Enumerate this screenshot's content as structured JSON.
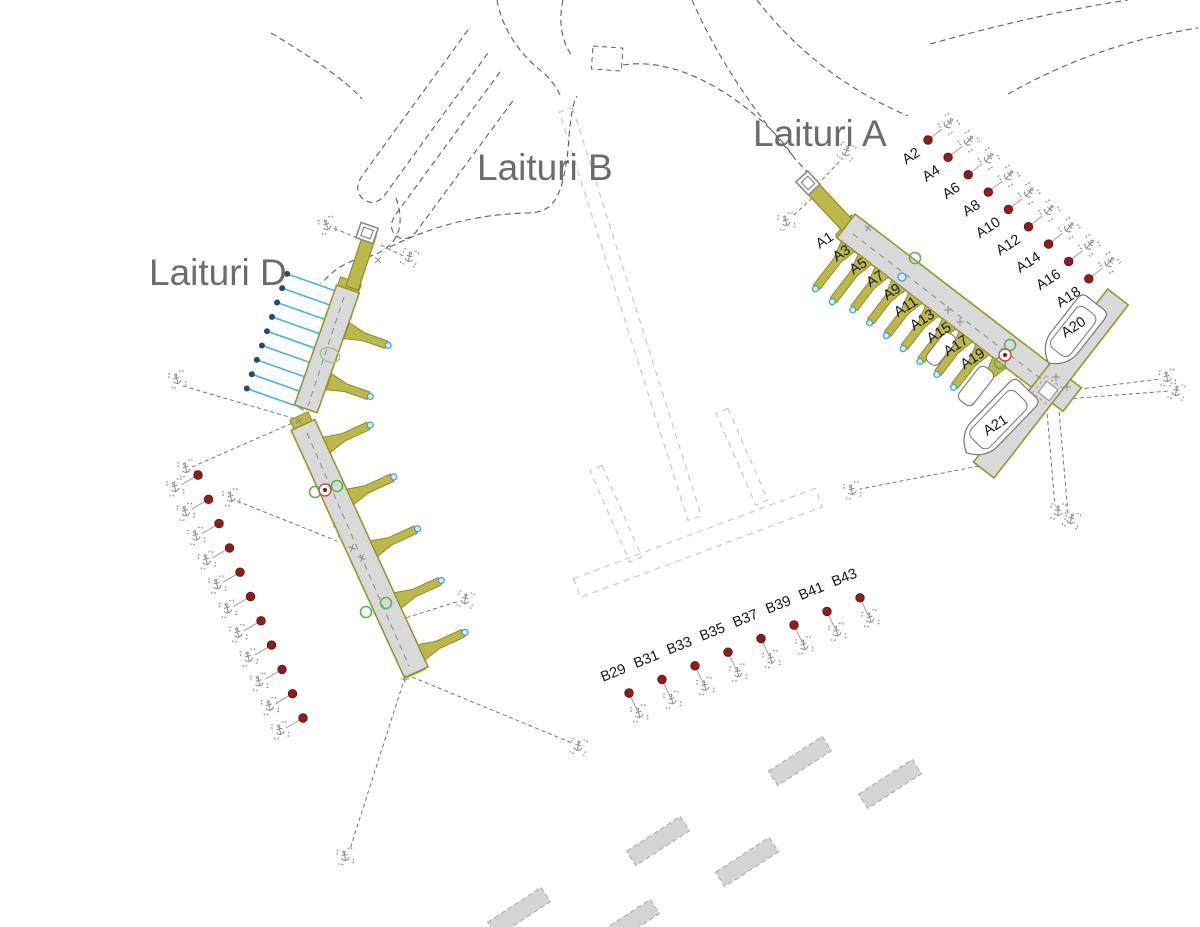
{
  "map": {
    "pier_labels": {
      "a": "Laituri A",
      "b": "Laituri B",
      "d": "Laituri D"
    },
    "berths": {
      "a_fingers": [
        "A1",
        "A3",
        "A5",
        "A7",
        "A9",
        "A11",
        "A13",
        "A15",
        "A17",
        "A19"
      ],
      "a_buoys": [
        "A2",
        "A4",
        "A6",
        "A8",
        "A10",
        "A12",
        "A14",
        "A16",
        "A18"
      ],
      "a_boats": [
        "A20",
        "A21"
      ],
      "b_buoys": [
        "B29",
        "B31",
        "B33",
        "B35",
        "B37",
        "B39",
        "B41",
        "B43"
      ]
    },
    "legend_icons": {
      "buoy": "red-buoy-dot",
      "anchor": "anchor-icon",
      "boom": "boom-mooring-line"
    },
    "colors": {
      "pier_fill": "#d9d9d9",
      "pier_stroke": "#97972f",
      "finger_fill": "#bcb94a",
      "finger_stroke": "#8f8c28",
      "buoy_red": "#8f1d1d",
      "boom_blue": "#45b6d8",
      "boom_dot": "#274a72",
      "green_marker": "#57b357",
      "green_light": "#8fcf8a",
      "teal_tip_fill": "#d3edf2",
      "teal_tip_stroke": "#3aa7c0",
      "red_ring": "#c0504d",
      "shore_dash": "#5f5f5f",
      "anchor_line": "#6a6a6a",
      "ghost_dash": "#c9c9c9",
      "title_gray": "#6c6c6c",
      "icon_gray": "#8a8a8a",
      "boat_stroke": "#777777",
      "breakwater_fill": "#d4d4d4",
      "breakwater_stroke": "#a9a9a9"
    }
  }
}
